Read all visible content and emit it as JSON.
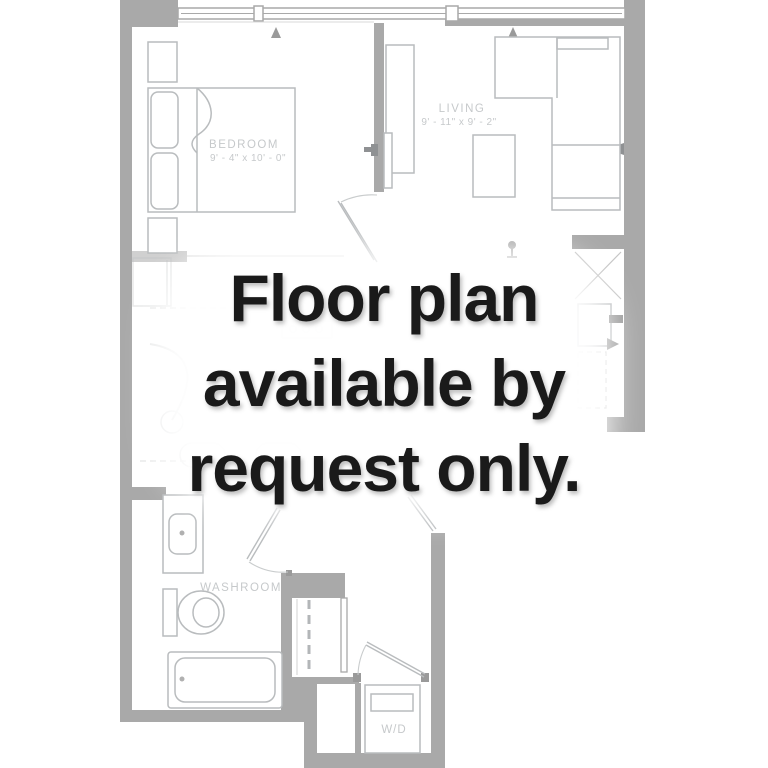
{
  "overlay": {
    "line1": "Floor plan",
    "line2": "available by",
    "line3": "request only."
  },
  "rooms": {
    "bedroom": {
      "name": "BEDROOM",
      "dims": "9' - 4\" x 10' - 0\""
    },
    "living": {
      "name": "LIVING",
      "dims": "9' - 11\" x 9' - 2\""
    },
    "washroom": {
      "name": "WASHROOM"
    },
    "laundry": {
      "name": "W/D"
    }
  },
  "colors": {
    "wall": "#a9a9a9",
    "furniture_line": "#b9bcbe",
    "fixture_dark": "#8f9193",
    "label": "#c6c9cb",
    "overlay_text": "#1a1a1a",
    "background": "#ffffff"
  }
}
